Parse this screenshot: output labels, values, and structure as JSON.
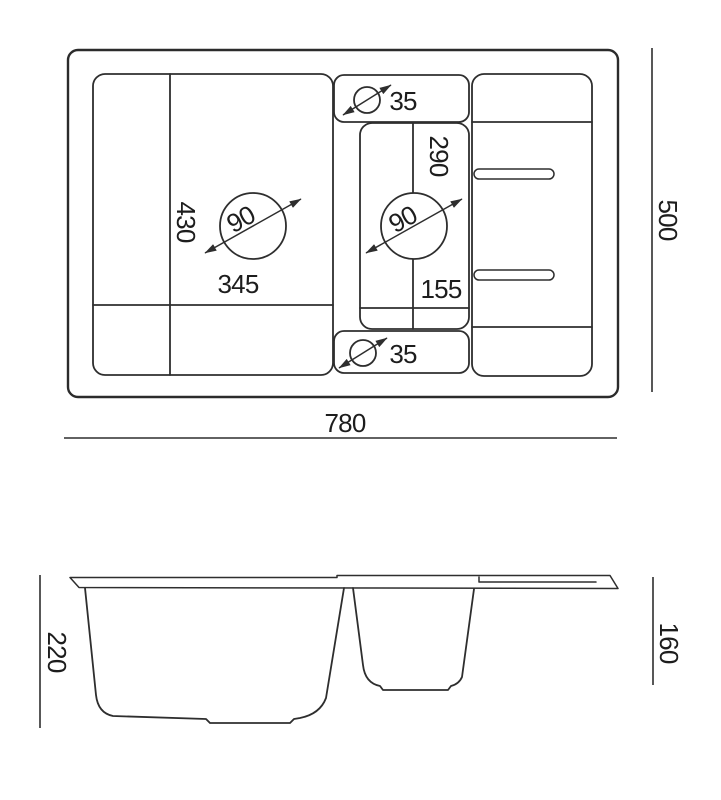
{
  "drawing": {
    "top_view": {
      "labels": {
        "main_bowl_depth": "430",
        "main_bowl_width": "345",
        "main_drain_diameter": "90",
        "small_bowl_depth": "290",
        "small_bowl_width": "155",
        "small_drain_diameter": "90",
        "tap_hole_top_diameter": "35",
        "tap_hole_bottom_diameter": "35"
      }
    },
    "dimensions": {
      "overall_width": "780",
      "overall_depth": "500",
      "main_bowl_height": "220",
      "small_bowl_height": "160"
    },
    "colors": {
      "line": "#2e2e2e",
      "text": "#1d1d1d",
      "background": "#ffffff"
    }
  }
}
